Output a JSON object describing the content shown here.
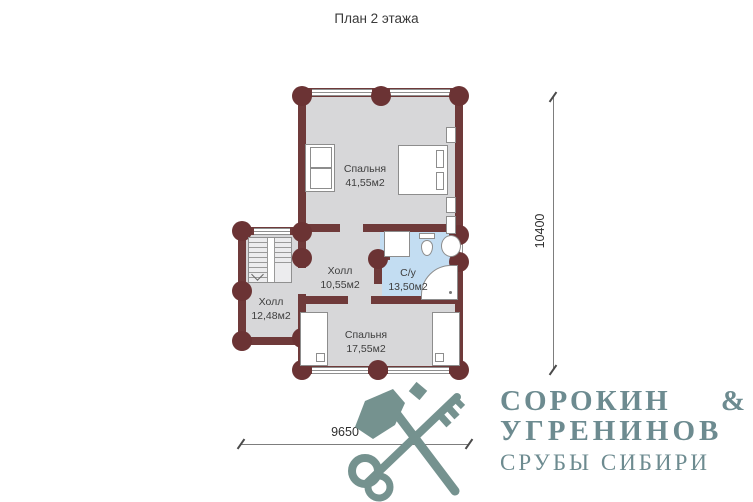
{
  "title": "План 2 этажа",
  "rooms": {
    "bedroom1": {
      "name": "Спальня",
      "area": "41,55м2"
    },
    "hall_main": {
      "name": "Холл",
      "area": "10,55м2"
    },
    "bathroom": {
      "name": "С/у",
      "area": "13,50м2"
    },
    "hall_annex": {
      "name": "Холл",
      "area": "12,48м2"
    },
    "bedroom2": {
      "name": "Спальня",
      "area": "17,55м2"
    }
  },
  "dimensions": {
    "height_mm": "10400",
    "width_mm": "9650"
  },
  "logo": {
    "name_line1": "СОРОКИН",
    "ampersand": "&",
    "name_line2": "УГРЕНИНОВ",
    "tagline": "СРУБЫ СИБИРИ",
    "icons": [
      "axe-icon",
      "key-icon"
    ]
  },
  "colors": {
    "wall": "#6f3a3a",
    "floor": "#d7d7d9",
    "bathroom_floor": "#c3ddf2",
    "logo": "#6d8b90"
  }
}
